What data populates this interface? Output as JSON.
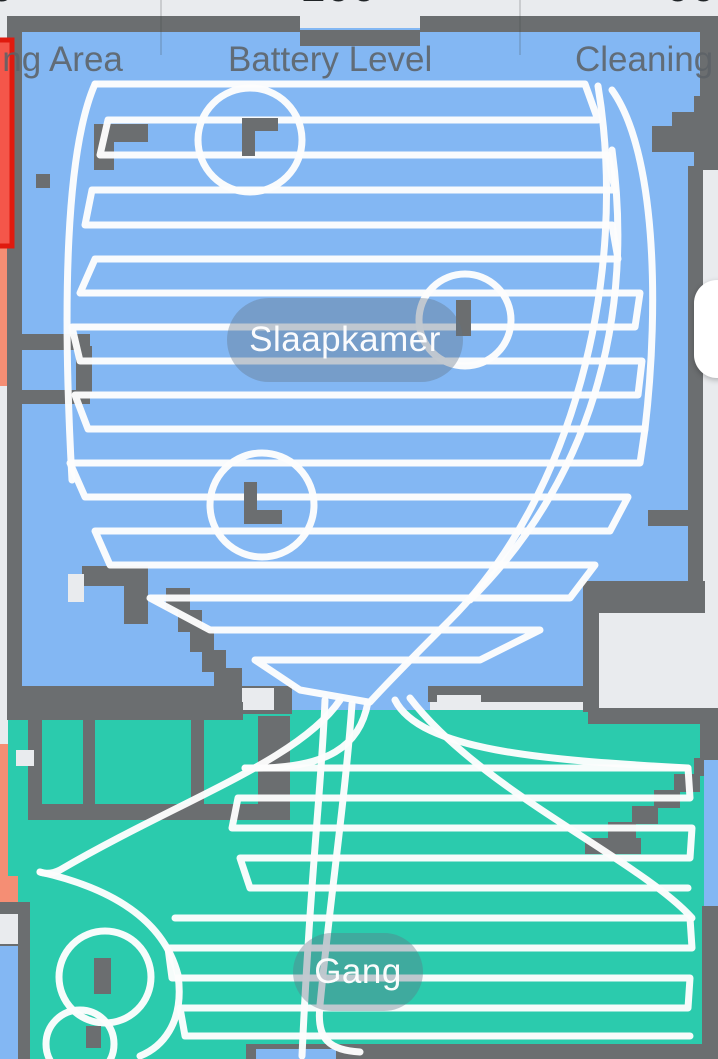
{
  "header": {
    "columns": [
      {
        "label": "Cleaning Area",
        "value_fragment": "6"
      },
      {
        "label": "Battery Level",
        "value_fragment": "100"
      },
      {
        "label": "Cleaning Time",
        "value_fragment": "00"
      }
    ]
  },
  "map": {
    "rooms": [
      {
        "name": "Slaapkamer",
        "color": "#83B7F3"
      },
      {
        "name": "Gang",
        "color": "#2BCBAD"
      }
    ],
    "colors": {
      "app_bg": "#E9EBEE",
      "wall": "#6B6E70",
      "room_blue": "#83B7F3",
      "room_teal": "#2BCBAD",
      "salmon": "#F58E74",
      "path": "#FDFDFD",
      "no_go_fill": "#F4564A",
      "no_go_border": "#E01A0E",
      "pill": "rgba(96,116,135,0.38)",
      "label_text": "#5D6267",
      "value_text": "#1F2326",
      "divider": "rgba(60,64,67,0.18)",
      "fab": "#FFFFFF"
    }
  }
}
